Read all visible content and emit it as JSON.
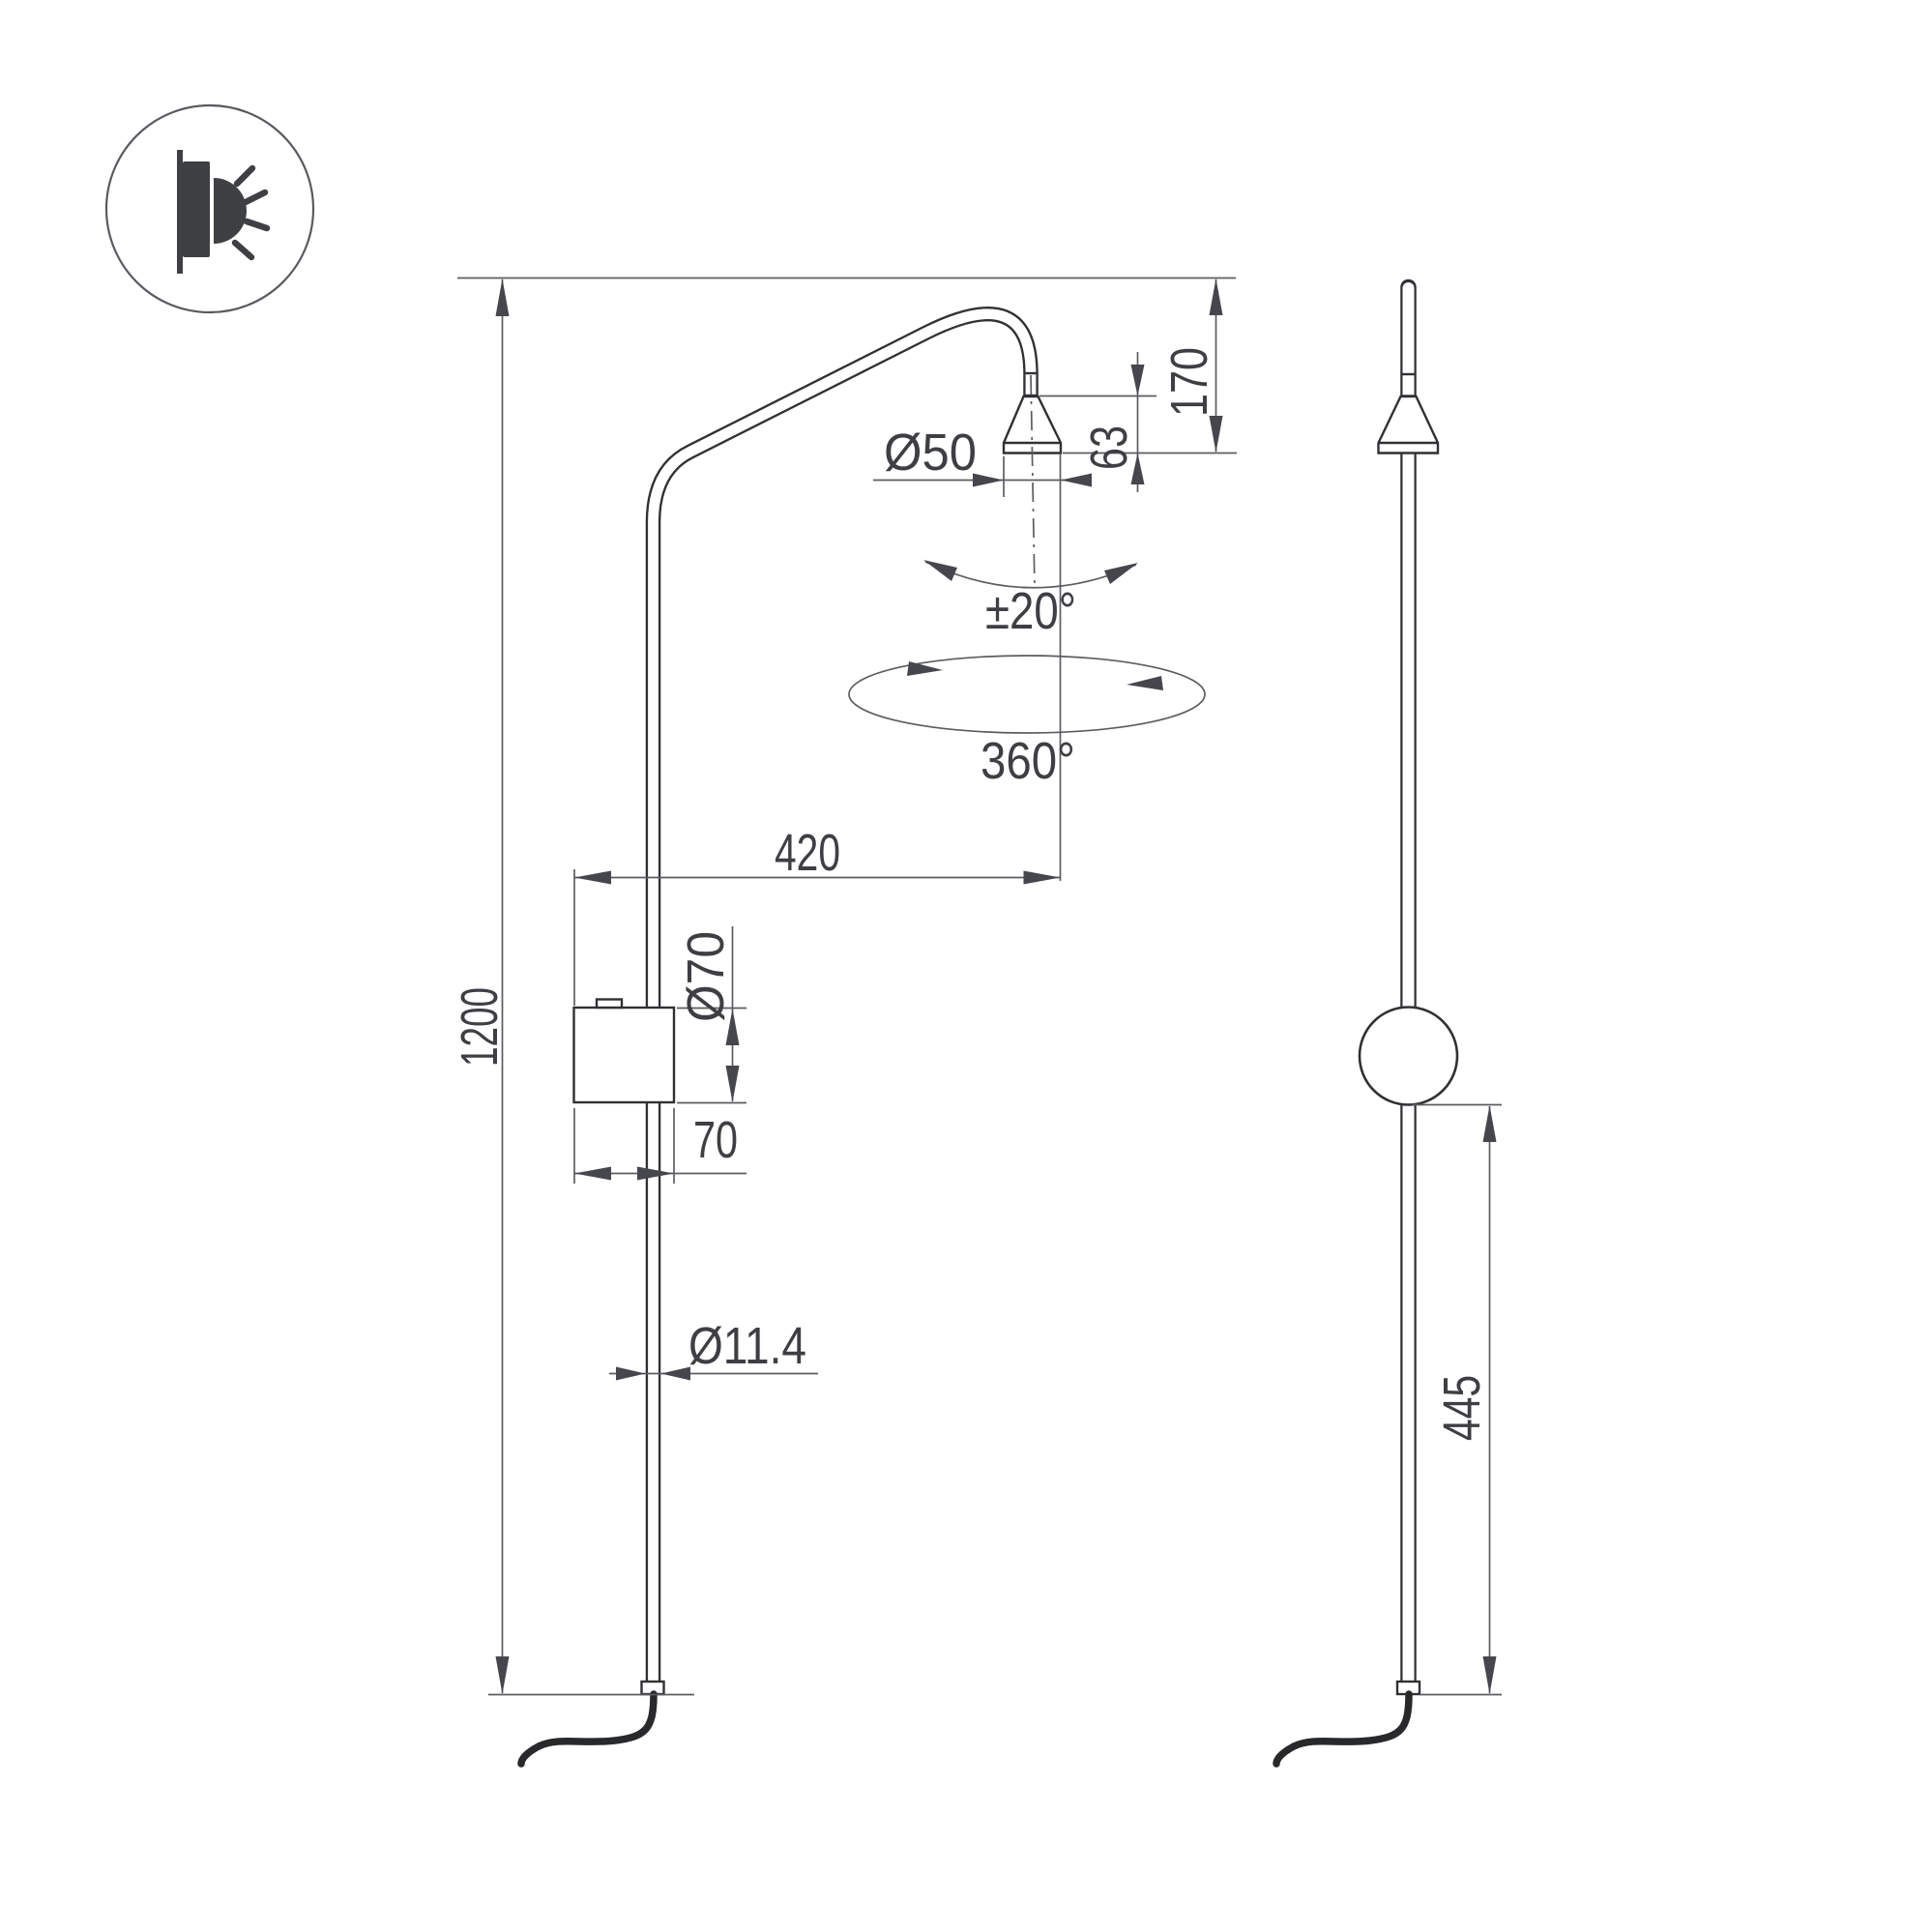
{
  "icon": {
    "name": "wall-light-icon"
  },
  "dimensions": {
    "overall_height": "1200",
    "arm_projection": "420",
    "head_diameter": "Ø50",
    "head_height": "63",
    "head_offset": "170",
    "canopy_diameter": "Ø70",
    "canopy_depth": "70",
    "pole_diameter": "Ø11.4",
    "tilt_range": "±20°",
    "rotation_range": "360°",
    "lower_section_height": "445"
  }
}
